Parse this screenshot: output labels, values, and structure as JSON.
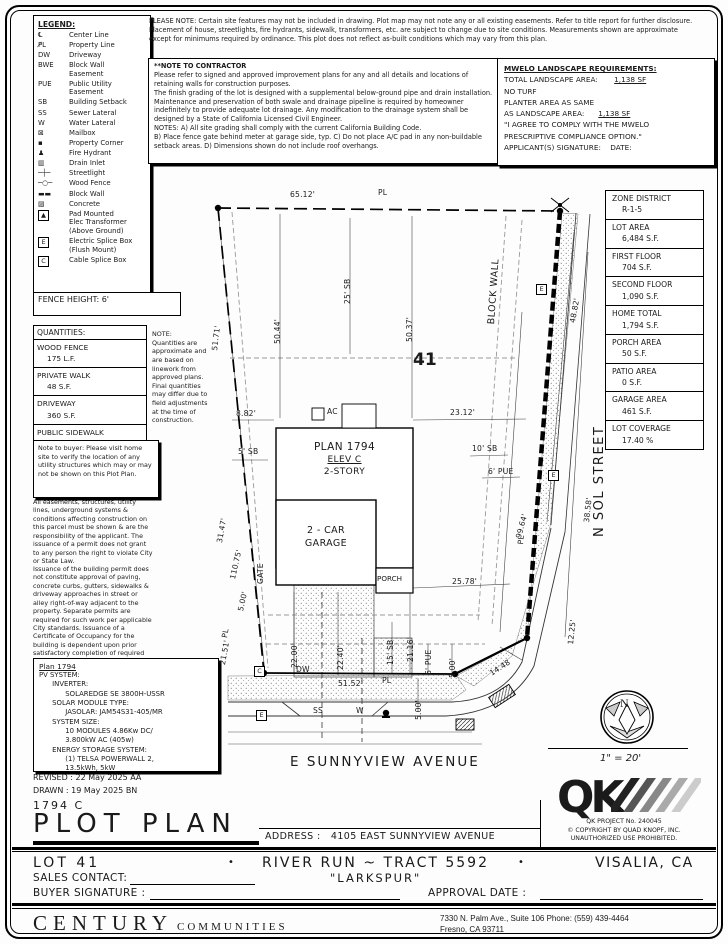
{
  "legend": {
    "title": "LEGEND:",
    "items": [
      {
        "g": "℄",
        "label": "Center Line"
      },
      {
        "g": "P̸L",
        "label": "Property Line"
      },
      {
        "g": "DW",
        "label": "Driveway"
      },
      {
        "g": "BWE",
        "label": "Block Wall\nEasement"
      },
      {
        "g": "PUE",
        "label": "Public Utility\nEasement"
      },
      {
        "g": "SB",
        "label": "Building Setback"
      },
      {
        "g": "SS",
        "label": "Sewer Lateral"
      },
      {
        "g": "W",
        "label": "Water Lateral"
      },
      {
        "g": "⊠",
        "label": "Mailbox"
      },
      {
        "g": "▪",
        "label": "Property Corner"
      },
      {
        "g": "♟",
        "label": "Fire Hydrant"
      },
      {
        "g": "▥",
        "label": "Drain Inlet"
      },
      {
        "g": "─┼─",
        "label": "Streetlight"
      },
      {
        "g": "─○─",
        "label": "Wood Fence"
      },
      {
        "g": "▬▬",
        "label": "Block Wall"
      },
      {
        "g": "▨",
        "label": "Concrete"
      },
      {
        "g": "▲",
        "label": "Pad Mounted\nElec Transformer\n(Above Ground)"
      },
      {
        "g": "E",
        "label": "Electric Splice Box\n(Flush Mount)"
      },
      {
        "g": "C",
        "label": "Cable Splice Box"
      }
    ]
  },
  "top_note": "PLEASE NOTE:  Certain site features may not be included in drawing.  Plot map may not note any or all existing easements. Refer to title report for further disclosure.  Placement of house, streetlights, fire hydrants, sidewalk, transformers, etc. are subject to change due to site conditions.  Measurements shown are approximate except for minimums required by ordinance.  This plot does not reflect as-built conditions which may vary from this plan.",
  "contractor_note": {
    "title": "**NOTE TO CONTRACTOR",
    "body": "Please refer to signed and approved improvement plans for any and all details and locations of retaining walls for construction purposes.\nThe finish grading of the lot is designed with a supplemental below-ground pipe and drain installation.  Maintenance and preservation of both swale and drainage pipeline is required by homeowner indefinitely to provide adequate lot drainage.  Any modification to the drainage system shall be designed by a State of California Licensed Civil Engineer.\nNOTES:  A) All site grading shall comply with the current California Building Code.\nB) Place fence gate behind meter at garage side, typ.  C) Do not place A/C pad in any non-buildable setback areas.  D) Dimensions shown do not include roof overhangs.",
    "asterisks": "**"
  },
  "mwelo": {
    "title": "MWELO LANDSCAPE REQUIREMENTS:",
    "total_label": "TOTAL LANDSCAPE AREA:",
    "total_value": "1,138 SF",
    "no_turf": "NO TURF",
    "planter_line1": "PLANTER AREA AS SAME",
    "planter_line2": "AS LANDSCAPE AREA:",
    "planter_value": "1,138 SF",
    "agree1": "\"I AGREE TO COMPLY WITH THE MWELO",
    "agree2": "PRESCRIPTIVE COMPLIANCE OPTION.\"",
    "sig_label": "APPLICANT(S) SIGNATURE:",
    "date_label": "DATE:"
  },
  "fence_height": "FENCE HEIGHT: 6'",
  "quantities": {
    "title": "QUANTITIES:",
    "items": [
      {
        "name": "WOOD FENCE",
        "value": "175 L.F."
      },
      {
        "name": "PRIVATE WALK",
        "value": "48 S.F."
      },
      {
        "name": "DRIVEWAY",
        "value": "360 S.F."
      },
      {
        "name": "PUBLIC SIDEWALK",
        "value": "345 S.F."
      }
    ]
  },
  "quantities_note": "NOTE:\nQuantities are approximate and are based on linework from approved plans.  Final quantities may differ due to field adjustments at the time of construction.",
  "buyer_note": "Note to buyer: Please visit home site to verify the location of any utility structures which may or may not be shown on this Plot Plan.",
  "easement_note": "All easements, structures, utility lines, underground systems & conditions affecting construction on this parcel must be shown & are the responsibility of the applicant. The issuance of a permit does not grant to any person the right to violate City or State Law.",
  "permit_note": "Issuance of the building permit does not constitute approval of paving, concrete curbs, gutters, sidewalks & driveway approaches in street or alley right-of-way adjacent to the property. Separate permits are required for such work per applicable City standards. Issuance of a Certificate of Occupancy for the building is dependent upon prior satisfactory completion of required pavement and concrete work.",
  "pv": {
    "title": "Plan 1794",
    "body": "PV SYSTEM:\n      INVERTER:\n            SOLAREDGE SE 3800H-USSR\n      SOLAR MODULE TYPE:\n            JASOLAR: JAM54S31-405/MR\n      SYSTEM SIZE:\n            10 MODULES 4.86Kw DC/\n            3.800kW AC (405w)\n      ENERGY STORAGE SYSTEM:\n            (1) TELSA POWERWALL 2,\n            13.5kWh, 5kW"
  },
  "revision": {
    "revised": "REVISED :  22 May 2025   AA",
    "drawn": "DRAWN :    19 May 2025   BN"
  },
  "site_table": {
    "rows": [
      {
        "label": "ZONE DISTRICT",
        "value": "R-1-5"
      },
      {
        "label": "LOT AREA",
        "value": "6,484 S.F."
      },
      {
        "label": "FIRST FLOOR",
        "value": "704 S.F."
      },
      {
        "label": "SECOND FLOOR",
        "value": "1,090 S.F."
      },
      {
        "label": "HOME TOTAL",
        "value": "1,794 S.F."
      },
      {
        "label": "PORCH AREA",
        "value": "50 S.F."
      },
      {
        "label": "PATIO AREA",
        "value": "0 S.F."
      },
      {
        "label": "GARAGE AREA",
        "value": "461 S.F."
      },
      {
        "label": "LOT COVERAGE",
        "value": "17.40 %"
      }
    ]
  },
  "drawing": {
    "lot_number": "41",
    "house": {
      "plan": "PLAN 1794",
      "elev": "ELEV C",
      "story": "2-STORY"
    },
    "garage1": "2 - CAR",
    "garage2": "GARAGE",
    "porch": "PORCH",
    "street_bottom": "E SUNNYVIEW AVENUE",
    "street_right": "N SOL STREET",
    "block_wall": "BLOCK WALL",
    "symbols": {
      "e": "E",
      "c": "C"
    },
    "dims": [
      "65.12'",
      "PL",
      "25' SB",
      "50.44'",
      "51.71'",
      "50.37'",
      "48.82'",
      "8.82'",
      "AC",
      "23.12'",
      "5' SB",
      "10' SB",
      "6' PUE",
      "31.47'",
      "110.75'",
      "GATE",
      "5.00'",
      "25.78'",
      "99.64'",
      "38.58'",
      "12.25'",
      "21.51'",
      "22.00'",
      "22.40'",
      "15' SB",
      "21.16'",
      "6' PUE",
      "5.00'",
      "5.00'",
      "14.48",
      "51.52'",
      "DW",
      "SS",
      "W",
      "PL",
      "PL",
      "PL"
    ]
  },
  "compass": {
    "n": "N"
  },
  "scale": "1\" = 20'",
  "qk": {
    "logo": "QK",
    "project": "QK PROJECT No. 240045",
    "copyright": "©   COPYRIGHT BY QUAD KNOPF, INC.",
    "unauthorized": "UNAUTHORIZED USE PROHIBITED."
  },
  "title_block": {
    "plan_code": "1794   C",
    "title": "PLOT PLAN",
    "address_label": "ADDRESS :",
    "address": "4105 EAST SUNNYVIEW AVENUE",
    "lot": "LOT 41",
    "tract": "RIVER RUN ~ TRACT 5592",
    "community": "\"LARKSPUR\"",
    "city": "VISALIA, CA",
    "bullet": "•",
    "sales_contact_label": "SALES CONTACT:",
    "buyer_signature_label": "BUYER SIGNATURE :",
    "approval_date_label": "APPROVAL DATE :"
  },
  "footer": {
    "company": "CENTURY",
    "company2": "COMMUNITIES",
    "address1": "7330 N. Palm Ave., Suite 106    Phone:  (559) 439-4464",
    "address2": "Fresno, CA  93711"
  }
}
